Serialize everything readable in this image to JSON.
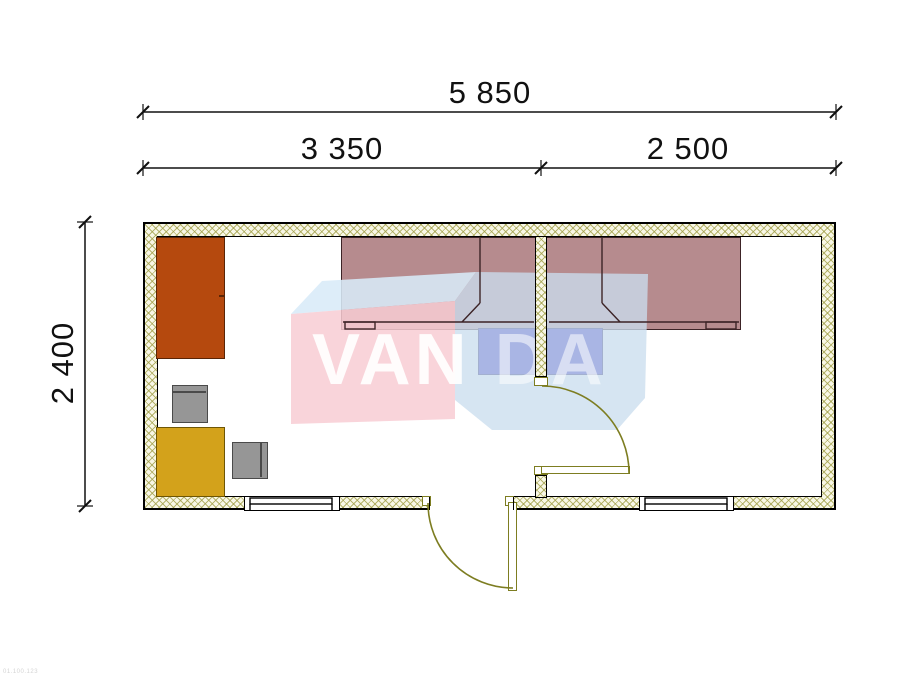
{
  "dimensions": {
    "total_width": {
      "label": "5 850"
    },
    "room1_width": {
      "label": "3 350"
    },
    "room2_width": {
      "label": "2 500"
    },
    "depth": {
      "label": "2 400"
    }
  },
  "watermark": {
    "front_text": "VAN",
    "back_text": "DA",
    "pink": "#f8cdd3",
    "blue_body": "#cbdeee",
    "blue_top": "#d8eaf8",
    "letter_color": "#ffffff"
  },
  "footer": {
    "code": "01.100.123"
  },
  "colors": {
    "wall_fill": "#f8f7e6",
    "wall_hatch": "#a09e46",
    "outline": "#000000",
    "dim": "#111111",
    "door": "#7d7d21",
    "wardrobe": "#b5490e",
    "wardrobe_border": "#5a2506",
    "table": "#d3a21b",
    "table_border": "#6e5604",
    "chair": "#969696",
    "chair_border": "#4a4a4a",
    "bed": "#b68b8e",
    "bed_border": "#3c2326",
    "nightstand": "#3226c0",
    "nightstand_border": "#191060"
  }
}
